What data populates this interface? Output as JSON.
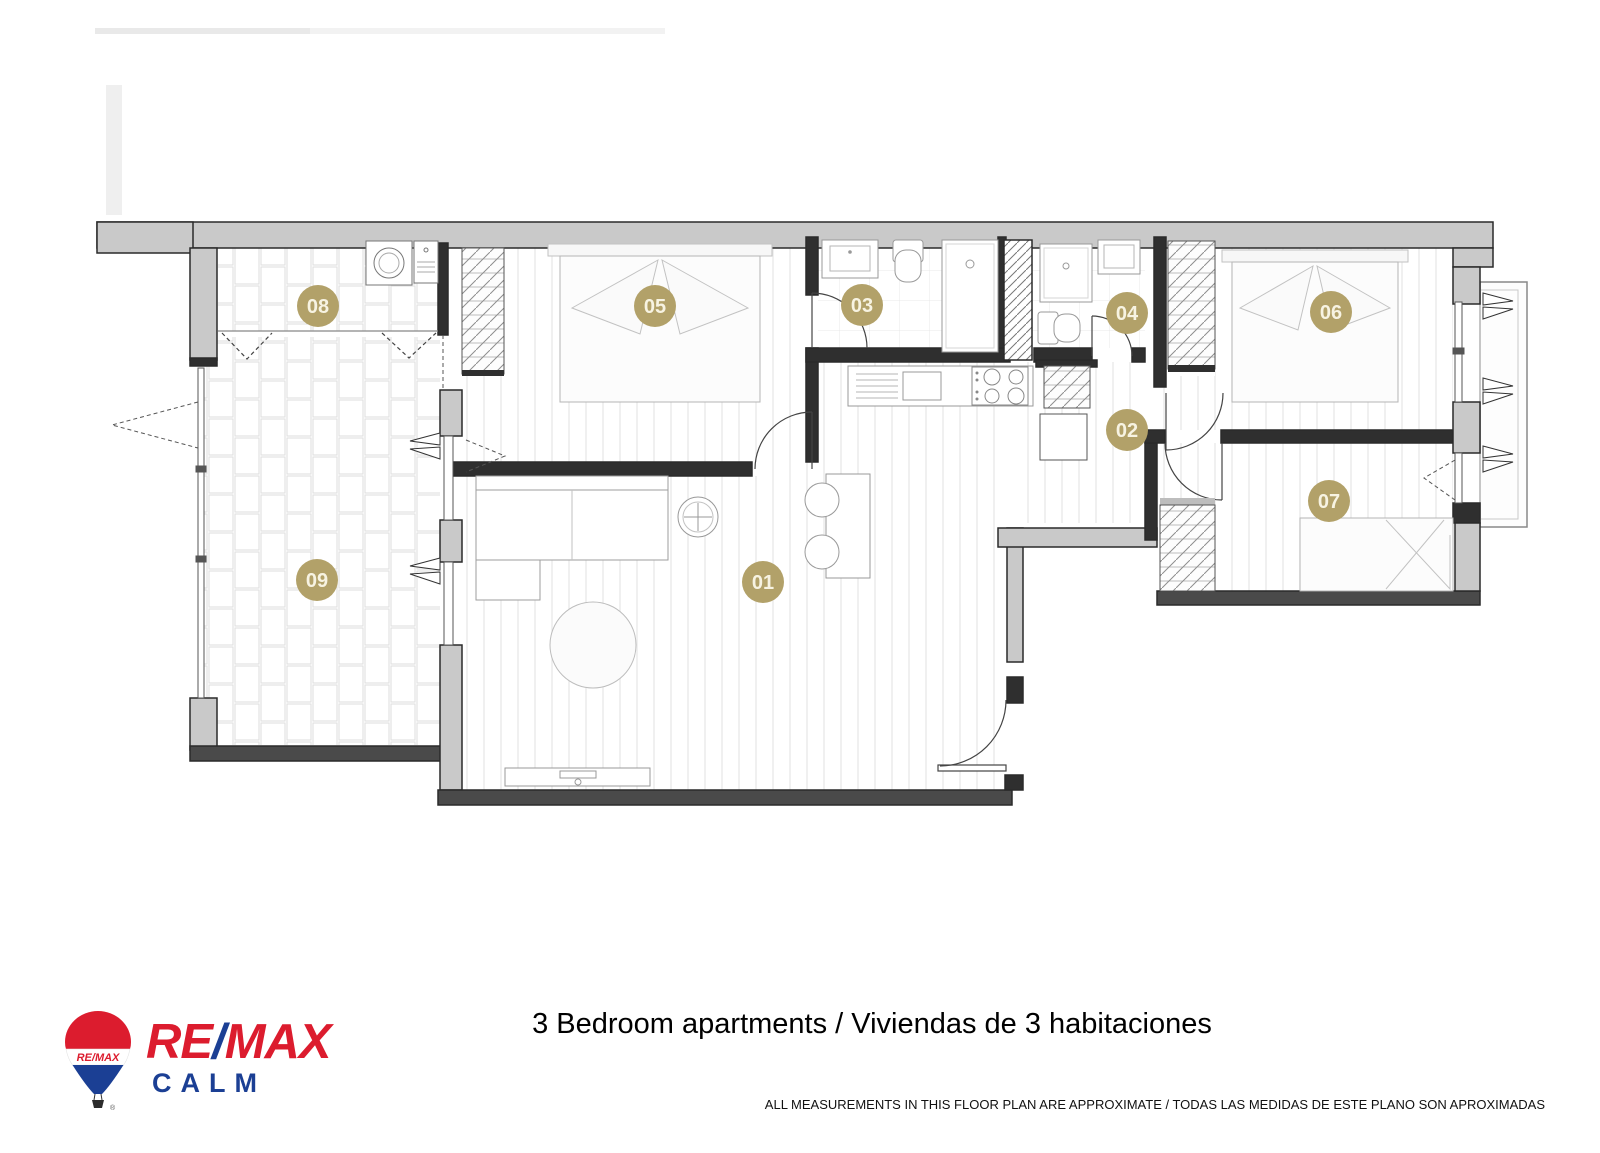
{
  "floor_plan": {
    "accent_circle_color": "#b2a169",
    "label_text_color": "#f7f3e2",
    "rooms": [
      {
        "id": "01",
        "cx": 763,
        "cy": 582
      },
      {
        "id": "02",
        "cx": 1127,
        "cy": 430
      },
      {
        "id": "03",
        "cx": 862,
        "cy": 305
      },
      {
        "id": "04",
        "cx": 1127,
        "cy": 313
      },
      {
        "id": "05",
        "cx": 655,
        "cy": 306
      },
      {
        "id": "06",
        "cx": 1331,
        "cy": 312
      },
      {
        "id": "07",
        "cx": 1329,
        "cy": 501
      },
      {
        "id": "08",
        "cx": 318,
        "cy": 306
      },
      {
        "id": "09",
        "cx": 317,
        "cy": 580
      }
    ]
  },
  "footer": {
    "logo": {
      "balloon_band_text": "RE/MAX",
      "wordmark_re": "RE",
      "wordmark_slash": "/",
      "wordmark_max": "MAX",
      "tagline": "CALM",
      "registered_mark": "®",
      "red": "#dc1c2e",
      "blue": "#1b3f94"
    },
    "title": "3 Bedroom apartments / Viviendas de 3 habitaciones",
    "disclaimer": "ALL MEASUREMENTS IN THIS FLOOR PLAN ARE APPROXIMATE / TODAS LAS MEDIDAS DE ESTE PLANO SON APROXIMADAS"
  }
}
